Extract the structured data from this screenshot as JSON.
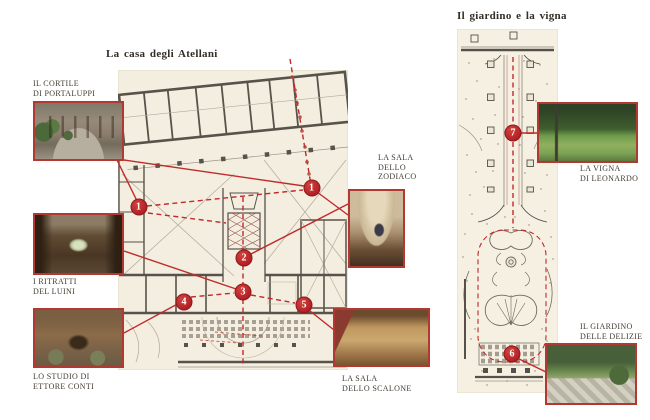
{
  "colors": {
    "accent": "#c0262c",
    "paper": "#f3eedf",
    "ink": "#433c32",
    "wall": "#57534b"
  },
  "left_panel": {
    "title": "La casa degli Atellani",
    "captions": {
      "cortile": {
        "line1": "IL CORTILE",
        "line2": "DI PORTALUPPI"
      },
      "ritratti": {
        "line1": "I RITRATTI",
        "line2": "DEL LUINI"
      },
      "studio": {
        "line1": "LO STUDIO DI",
        "line2": "ETTORE CONTI"
      },
      "zodiaco": {
        "line1": "LA SALA",
        "line2": "DELLO",
        "line3": "ZODIACO"
      },
      "scalone": {
        "line1": "LA SALA",
        "line2": "DELLO SCALONE"
      }
    },
    "markers": {
      "m1a": "1",
      "m1b": "1",
      "m2": "2",
      "m3": "3",
      "m4": "4",
      "m5": "5"
    }
  },
  "right_panel": {
    "title": "Il giardino e la vigna",
    "captions": {
      "vigna": {
        "line1": "LA VIGNA",
        "line2": "DI LEONARDO"
      },
      "delizie": {
        "line1": "IL GIARDINO",
        "line2": "DELLE DELIZIE"
      }
    },
    "markers": {
      "m7": "7",
      "m6": "6"
    }
  }
}
